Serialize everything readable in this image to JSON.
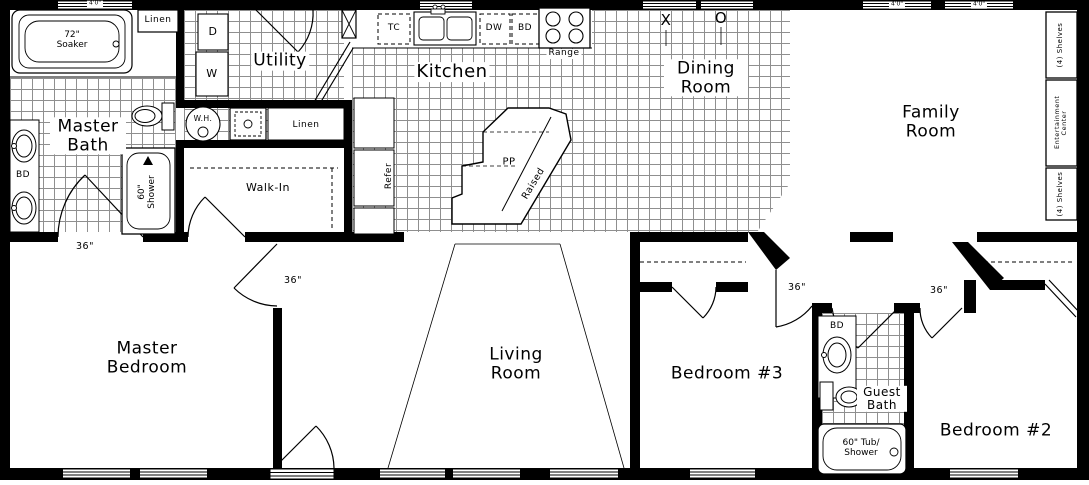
{
  "rooms": {
    "master_bath": "Master Bath",
    "utility": "Utility",
    "kitchen": "Kitchen",
    "dining_room": "Dining Room",
    "family_room": "Family Room",
    "master_bedroom": "Master Bedroom",
    "living_room": "Living Room",
    "bedroom3": "Bedroom #3",
    "guest_bath": "Guest Bath",
    "bedroom2": "Bedroom #2",
    "walk_in": "Walk-In",
    "linen_master": "Linen",
    "linen_hall": "Linen"
  },
  "fixtures": {
    "soaker_tub": "72\" Soaker",
    "shower": "60\" Shower",
    "tub_shower": "60\" Tub/ Shower",
    "water_heater": "W.H.",
    "dryer": "D",
    "washer": "W",
    "vanity_master": "BD",
    "vanity_guest": "BD",
    "trash_compactor": "TC",
    "dishwasher": "DW",
    "base_cabinet": "BD",
    "range": "Range",
    "refrigerator": "Refer",
    "island_prep": "PP",
    "island_raised": "Raised",
    "shelves_upper": "(4) Shelves",
    "entertainment_center": "Entertainment Center",
    "shelves_lower": "(4) Shelves",
    "window_mark_x": "X",
    "window_mark_o": "O"
  },
  "dimensions": {
    "master_bath_door": "36\"",
    "master_bedroom_door": "36\"",
    "bedroom3_door": "36\"",
    "bedroom2_door": "36\"",
    "window_top_left": "4'0\"",
    "window_family_1": "4'0\"",
    "window_family_2": "4'0\""
  }
}
